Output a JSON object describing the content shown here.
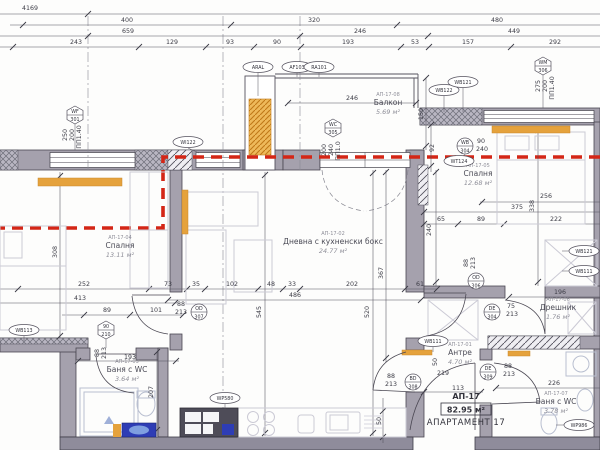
{
  "apartment": {
    "code": "АП-17",
    "area": "82.95 м²",
    "name": "АПАРТАМЕНТ 17"
  },
  "rooms": [
    {
      "code": "АП-17-04",
      "name": "Спалня",
      "area": "13.11 м²",
      "x": 120,
      "y": 248
    },
    {
      "code": "АП-17-02",
      "name": "Дневна с кухненски бокс",
      "area": "24.77 м²",
      "x": 333,
      "y": 244
    },
    {
      "code": "АП-17-08",
      "name": "Балкон",
      "area": "5.69 м²",
      "x": 388,
      "y": 105
    },
    {
      "code": "АП-17-05",
      "name": "Спалня",
      "area": "12.68 м²",
      "x": 478,
      "y": 176
    },
    {
      "code": "АП-17-06",
      "name": "Дрешник",
      "area": "1.76 м²",
      "x": 558,
      "y": 310
    },
    {
      "code": "АП-17-01",
      "name": "Антре",
      "area": "4.70 м²",
      "x": 460,
      "y": 355
    },
    {
      "code": "АП-17-03",
      "name": "Баня с WC",
      "area": "3.64 м²",
      "x": 127,
      "y": 372
    },
    {
      "code": "АП-17-07",
      "name": "Баня с WC",
      "area": "3.78 м²",
      "x": 556,
      "y": 404
    }
  ],
  "dims": [
    {
      "t": "4169",
      "x": 30,
      "y": 10
    },
    {
      "t": "400",
      "x": 127,
      "y": 22
    },
    {
      "t": "320",
      "x": 314,
      "y": 22
    },
    {
      "t": "480",
      "x": 497,
      "y": 22
    },
    {
      "t": "659",
      "x": 128,
      "y": 33
    },
    {
      "t": "246",
      "x": 360,
      "y": 33
    },
    {
      "t": "449",
      "x": 514,
      "y": 33
    },
    {
      "t": "243",
      "x": 76,
      "y": 44
    },
    {
      "t": "129",
      "x": 172,
      "y": 44
    },
    {
      "t": "93",
      "x": 230,
      "y": 44
    },
    {
      "t": "90",
      "x": 277,
      "y": 44
    },
    {
      "t": "193",
      "x": 348,
      "y": 44
    },
    {
      "t": "53",
      "x": 415,
      "y": 44
    },
    {
      "t": "157",
      "x": 468,
      "y": 44
    },
    {
      "t": "292",
      "x": 555,
      "y": 44
    },
    {
      "t": "246",
      "x": 352,
      "y": 100
    },
    {
      "t": "150",
      "x": 423,
      "y": 114,
      "r": -90
    },
    {
      "t": "92",
      "x": 434,
      "y": 148,
      "r": -90
    },
    {
      "t": "90",
      "x": 481,
      "y": 143
    },
    {
      "t": "240",
      "x": 482,
      "y": 151
    },
    {
      "t": "275",
      "x": 540,
      "y": 86,
      "r": -90
    },
    {
      "t": "200",
      "x": 547,
      "y": 86,
      "r": -90
    },
    {
      "t": "ПП1.40",
      "x": 554,
      "y": 88,
      "r": -90
    },
    {
      "t": "250",
      "x": 67,
      "y": 135,
      "r": -90
    },
    {
      "t": "200",
      "x": 74,
      "y": 135,
      "r": -90
    },
    {
      "t": "ПП1.40",
      "x": 81,
      "y": 137,
      "r": -90
    },
    {
      "t": "200",
      "x": 326,
      "y": 150,
      "r": -90
    },
    {
      "t": "240",
      "x": 333,
      "y": 150,
      "r": -90
    },
    {
      "t": "ПП1.0",
      "x": 340,
      "y": 151,
      "r": -90
    },
    {
      "t": "308",
      "x": 57,
      "y": 252,
      "r": -90
    },
    {
      "t": "252",
      "x": 84,
      "y": 286
    },
    {
      "t": "73",
      "x": 168,
      "y": 286
    },
    {
      "t": "35",
      "x": 196,
      "y": 286
    },
    {
      "t": "102",
      "x": 232,
      "y": 286
    },
    {
      "t": "48",
      "x": 271,
      "y": 286
    },
    {
      "t": "33",
      "x": 292,
      "y": 286
    },
    {
      "t": "202",
      "x": 352,
      "y": 286
    },
    {
      "t": "61",
      "x": 420,
      "y": 286
    },
    {
      "t": "413",
      "x": 80,
      "y": 300
    },
    {
      "t": "486",
      "x": 295,
      "y": 297
    },
    {
      "t": "89",
      "x": 107,
      "y": 312
    },
    {
      "t": "101",
      "x": 156,
      "y": 312
    },
    {
      "t": "88",
      "x": 181,
      "y": 306
    },
    {
      "t": "213",
      "x": 181,
      "y": 314
    },
    {
      "t": "545",
      "x": 261,
      "y": 312,
      "r": -90
    },
    {
      "t": "520",
      "x": 369,
      "y": 312,
      "r": -90
    },
    {
      "t": "367",
      "x": 383,
      "y": 273,
      "r": -90
    },
    {
      "t": "256",
      "x": 546,
      "y": 198
    },
    {
      "t": "375",
      "x": 517,
      "y": 209
    },
    {
      "t": "338",
      "x": 534,
      "y": 206,
      "r": -90
    },
    {
      "t": "65",
      "x": 441,
      "y": 221
    },
    {
      "t": "89",
      "x": 481,
      "y": 221
    },
    {
      "t": "222",
      "x": 556,
      "y": 221
    },
    {
      "t": "240",
      "x": 431,
      "y": 230,
      "r": -90
    },
    {
      "t": "88",
      "x": 468,
      "y": 263,
      "r": -90
    },
    {
      "t": "213",
      "x": 475,
      "y": 263,
      "r": -90
    },
    {
      "t": "196",
      "x": 560,
      "y": 294
    },
    {
      "t": "75",
      "x": 511,
      "y": 308
    },
    {
      "t": "213",
      "x": 512,
      "y": 316
    },
    {
      "t": "226",
      "x": 554,
      "y": 385
    },
    {
      "t": "88",
      "x": 508,
      "y": 368
    },
    {
      "t": "213",
      "x": 509,
      "y": 376
    },
    {
      "t": "219",
      "x": 443,
      "y": 375
    },
    {
      "t": "113",
      "x": 458,
      "y": 390
    },
    {
      "t": "88",
      "x": 391,
      "y": 378
    },
    {
      "t": "213",
      "x": 391,
      "y": 386
    },
    {
      "t": "50",
      "x": 437,
      "y": 362,
      "r": -90
    },
    {
      "t": "50",
      "x": 381,
      "y": 421,
      "r": -90
    },
    {
      "t": "193",
      "x": 130,
      "y": 359
    },
    {
      "t": "207",
      "x": 153,
      "y": 392,
      "r": -90
    },
    {
      "t": "88",
      "x": 99,
      "y": 353,
      "r": -90
    },
    {
      "t": "213",
      "x": 106,
      "y": 353,
      "r": -90
    }
  ],
  "tags": {
    "ovals": [
      {
        "t": "ARAL",
        "x": 258,
        "y": 67
      },
      {
        "t": "AF103",
        "x": 297,
        "y": 67
      },
      {
        "t": "RA101",
        "x": 319,
        "y": 67
      },
      {
        "t": "WB122",
        "x": 444,
        "y": 90
      },
      {
        "t": "WB121",
        "x": 463,
        "y": 82
      },
      {
        "t": "WI122",
        "x": 188,
        "y": 142
      },
      {
        "t": "WB113",
        "x": 24,
        "y": 330
      },
      {
        "t": "WB111",
        "x": 433,
        "y": 341
      },
      {
        "t": "WB121",
        "x": 584,
        "y": 251
      },
      {
        "t": "WB111",
        "x": 584,
        "y": 271
      },
      {
        "t": "WT124",
        "x": 459,
        "y": 161
      },
      {
        "t": "WP580",
        "x": 225,
        "y": 398
      },
      {
        "t": "WP986",
        "x": 579,
        "y": 425
      }
    ],
    "hexes": [
      {
        "a": "WF",
        "b": "301",
        "x": 75,
        "y": 115
      },
      {
        "a": "WC",
        "b": "305",
        "x": 333,
        "y": 128
      },
      {
        "a": "WM",
        "b": "306",
        "x": 543,
        "y": 66
      },
      {
        "a": "90",
        "b": "210",
        "x": 106,
        "y": 330
      }
    ],
    "circles": [
      {
        "a": "OD",
        "b": "307",
        "x": 199,
        "y": 312
      },
      {
        "a": "OD",
        "b": "306",
        "x": 476,
        "y": 281
      },
      {
        "a": "DE",
        "b": "304",
        "x": 492,
        "y": 312
      },
      {
        "a": "DE",
        "b": "309",
        "x": 488,
        "y": 372
      },
      {
        "a": "BD",
        "b": "308",
        "x": 413,
        "y": 382
      },
      {
        "a": "WB",
        "b": "304",
        "x": 465,
        "y": 146
      }
    ]
  },
  "colors": {
    "wall": "#a5a1ad",
    "wall_dark": "#8f8c9b",
    "radiator": "#e5a23c",
    "red_line": "#d42616",
    "vanity_blue": "#2e3db5",
    "sink_blue": "#7f9fe0"
  }
}
